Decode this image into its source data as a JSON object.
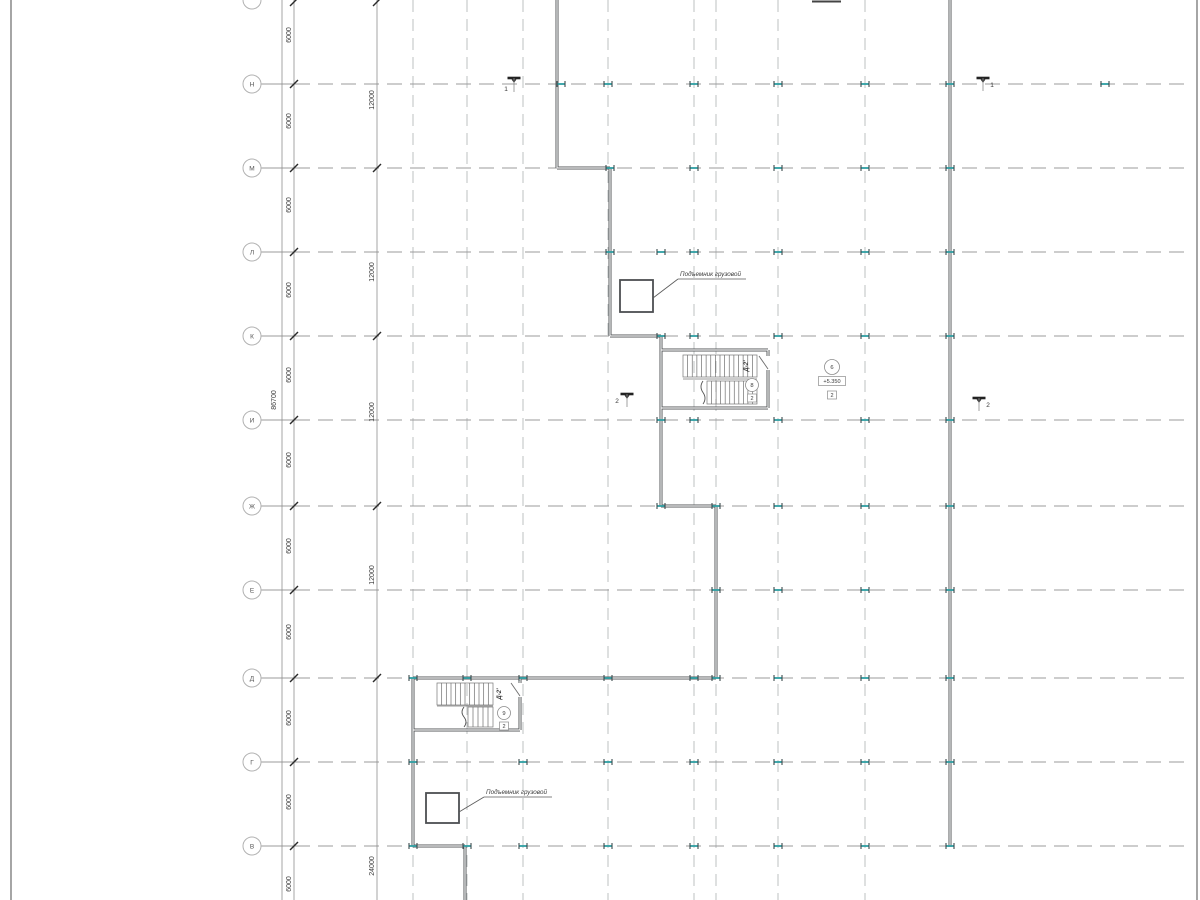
{
  "drawing": {
    "type": "architectural-floor-plan",
    "language": "ru"
  },
  "colors": {
    "background": "#ffffff",
    "border": "#6a6a6a",
    "row_line": "#9b9b9b",
    "grid_line": "#bdc0c2",
    "wall": "#54575a",
    "wall_core": "#f5f5f5",
    "thin": "#6e6e6e",
    "dim_line": "#8f8f8f",
    "tick": "#2a2a2a",
    "text": "#3a3a3a",
    "column_flange": "#2e9fa3",
    "column_bar": "#3c4a4d"
  },
  "sheet": {
    "width": 1200,
    "height": 900,
    "left_border_x": 11,
    "right_border_x": 1197
  },
  "axis_rows": {
    "circle_x": 252,
    "circle_r": 9,
    "line_end_x": 1192,
    "items": [
      {
        "label": "",
        "y": 0,
        "partial": true
      },
      {
        "label": "Н",
        "y": 84
      },
      {
        "label": "М",
        "y": 168
      },
      {
        "label": "Л",
        "y": 252
      },
      {
        "label": "К",
        "y": 336
      },
      {
        "label": "И",
        "y": 420
      },
      {
        "label": "Ж",
        "y": 506
      },
      {
        "label": "Е",
        "y": 590
      },
      {
        "label": "Д",
        "y": 678
      },
      {
        "label": "Г",
        "y": 762
      },
      {
        "label": "В",
        "y": 846
      }
    ]
  },
  "grid_columns": {
    "xs": [
      413,
      467,
      523,
      608,
      694,
      716,
      778,
      865
    ]
  },
  "dimensions": {
    "overall": {
      "line_x": 282,
      "label": "86700",
      "label_x": 276,
      "label_y": 400
    },
    "chain_6000": {
      "line_x": 294,
      "label_x": 291,
      "tick_ys": [
        2,
        84,
        168,
        252,
        336,
        420,
        506,
        590,
        678,
        762,
        846
      ],
      "labels": [
        {
          "text": "6000",
          "y": 35
        },
        {
          "text": "6000",
          "y": 121
        },
        {
          "text": "6000",
          "y": 205
        },
        {
          "text": "6000",
          "y": 290
        },
        {
          "text": "6000",
          "y": 375
        },
        {
          "text": "6000",
          "y": 460
        },
        {
          "text": "6000",
          "y": 546
        },
        {
          "text": "6000",
          "y": 632
        },
        {
          "text": "6000",
          "y": 718
        },
        {
          "text": "6000",
          "y": 802
        },
        {
          "text": "6000",
          "y": 884
        }
      ]
    },
    "chain_12000": {
      "line_x": 377,
      "label_x": 374,
      "tick_ys": [
        2,
        168,
        336,
        506,
        678
      ],
      "labels": [
        {
          "text": "12000",
          "y": 100
        },
        {
          "text": "12000",
          "y": 272
        },
        {
          "text": "12000",
          "y": 412
        },
        {
          "text": "12000",
          "y": 575
        },
        {
          "text": "24000",
          "y": 866
        }
      ]
    }
  },
  "walls": {
    "segments": [
      [
        557,
        0,
        557,
        168
      ],
      [
        557,
        168,
        610,
        168
      ],
      [
        610,
        168,
        610,
        336
      ],
      [
        610,
        336,
        661,
        336
      ],
      [
        661,
        336,
        661,
        506
      ],
      [
        661,
        506,
        716,
        506
      ],
      [
        716,
        506,
        716,
        678
      ],
      [
        413,
        678,
        716,
        678
      ],
      [
        413,
        678,
        413,
        846
      ],
      [
        413,
        846,
        465,
        846
      ],
      [
        465,
        846,
        465,
        900
      ],
      [
        950,
        0,
        950,
        847
      ],
      [
        661,
        350,
        768,
        350
      ],
      [
        768,
        350,
        768,
        356
      ],
      [
        768,
        370,
        768,
        408
      ],
      [
        661,
        408,
        768,
        408
      ],
      [
        520,
        678,
        520,
        683
      ],
      [
        520,
        697,
        520,
        730
      ],
      [
        413,
        730,
        520,
        730
      ]
    ]
  },
  "doors": [
    [
      759,
      356,
      768,
      369
    ],
    [
      511,
      683,
      520,
      696
    ]
  ],
  "stairs": [
    {
      "name": "stair-upper",
      "label": "Д-2'",
      "label_x": 748,
      "label_y": 366,
      "room_circle": {
        "text": "8",
        "x": 752,
        "y": 385,
        "r": 6.5
      },
      "type_square": {
        "text": "2",
        "x": 752,
        "y": 398
      },
      "flights": [
        {
          "x": 683,
          "y": 355,
          "w": 74,
          "h": 22,
          "treads": 16
        },
        {
          "x": 707,
          "y": 381,
          "w": 50,
          "h": 23,
          "treads": 11
        }
      ],
      "divider": [
        683,
        379,
        757,
        379
      ],
      "break_line": {
        "x": 703,
        "y": 381,
        "h": 23
      }
    },
    {
      "name": "stair-lower",
      "label": "Д-2'",
      "label_x": 501,
      "label_y": 694,
      "room_circle": {
        "text": "9",
        "x": 504,
        "y": 713,
        "r": 6.5
      },
      "type_square": {
        "text": "2",
        "x": 504,
        "y": 726
      },
      "flights": [
        {
          "x": 437,
          "y": 683,
          "w": 56,
          "h": 22,
          "treads": 12
        },
        {
          "x": 468,
          "y": 707,
          "w": 25,
          "h": 20,
          "treads": 5
        }
      ],
      "divider": [
        437,
        706,
        493,
        706
      ],
      "break_line": {
        "x": 464,
        "y": 707,
        "h": 20
      }
    }
  ],
  "elevators": [
    {
      "label": "Подъемник грузовой",
      "rect": {
        "x": 620,
        "y": 280,
        "w": 33,
        "h": 32
      },
      "leader": [
        [
          653,
          298,
          678,
          279
        ],
        [
          678,
          279,
          746,
          279
        ]
      ],
      "label_x": 680,
      "label_y": 276
    },
    {
      "label": "Подъемник грузовой",
      "rect": {
        "x": 426,
        "y": 793,
        "w": 33,
        "h": 30
      },
      "leader": [
        [
          459,
          812,
          484,
          797
        ],
        [
          484,
          797,
          552,
          797
        ]
      ],
      "label_x": 486,
      "label_y": 794
    }
  ],
  "room_marker": {
    "circle": {
      "text": "6",
      "x": 832,
      "y": 367,
      "r": 7.5
    },
    "level_box": {
      "text": "+5.350",
      "x": 832,
      "y": 381,
      "w": 27,
      "h": 9
    },
    "type_square": {
      "text": "2",
      "x": 832,
      "y": 395
    }
  },
  "section_marks": [
    {
      "label": "1",
      "x": 514,
      "y": 78,
      "stem": 14,
      "label_dx": -8,
      "label_dy": 13
    },
    {
      "label": "1",
      "x": 983,
      "y": 78,
      "stem": 13,
      "label_dx": 9,
      "label_dy": 9
    },
    {
      "label": "2",
      "x": 627,
      "y": 394,
      "stem": 13,
      "label_dx": -10,
      "label_dy": 9
    },
    {
      "label": "2",
      "x": 979,
      "y": 398,
      "stem": 13,
      "label_dx": 9,
      "label_dy": 9
    }
  ],
  "columns": {
    "points": [
      [
        561,
        84
      ],
      [
        608,
        84
      ],
      [
        694,
        84
      ],
      [
        778,
        84
      ],
      [
        865,
        84
      ],
      [
        950,
        84
      ],
      [
        1105,
        84
      ],
      [
        610,
        168
      ],
      [
        694,
        168
      ],
      [
        778,
        168
      ],
      [
        865,
        168
      ],
      [
        950,
        168
      ],
      [
        610,
        252
      ],
      [
        661,
        252
      ],
      [
        694,
        252
      ],
      [
        778,
        252
      ],
      [
        865,
        252
      ],
      [
        950,
        252
      ],
      [
        661,
        336
      ],
      [
        694,
        336
      ],
      [
        778,
        336
      ],
      [
        865,
        336
      ],
      [
        950,
        336
      ],
      [
        661,
        420
      ],
      [
        694,
        420
      ],
      [
        778,
        420
      ],
      [
        865,
        420
      ],
      [
        950,
        420
      ],
      [
        661,
        506
      ],
      [
        716,
        506
      ],
      [
        778,
        506
      ],
      [
        865,
        506
      ],
      [
        950,
        506
      ],
      [
        716,
        590
      ],
      [
        778,
        590
      ],
      [
        865,
        590
      ],
      [
        950,
        590
      ],
      [
        413,
        678
      ],
      [
        467,
        678
      ],
      [
        523,
        678
      ],
      [
        608,
        678
      ],
      [
        694,
        678
      ],
      [
        716,
        678
      ],
      [
        778,
        678
      ],
      [
        865,
        678
      ],
      [
        950,
        678
      ],
      [
        413,
        762
      ],
      [
        523,
        762
      ],
      [
        608,
        762
      ],
      [
        694,
        762
      ],
      [
        778,
        762
      ],
      [
        865,
        762
      ],
      [
        950,
        762
      ],
      [
        413,
        846
      ],
      [
        467,
        846
      ],
      [
        523,
        846
      ],
      [
        608,
        846
      ],
      [
        694,
        846
      ],
      [
        778,
        846
      ],
      [
        865,
        846
      ],
      [
        950,
        846
      ]
    ]
  },
  "top_cut_mark": [
    812,
    1.5,
    841,
    1.5
  ]
}
